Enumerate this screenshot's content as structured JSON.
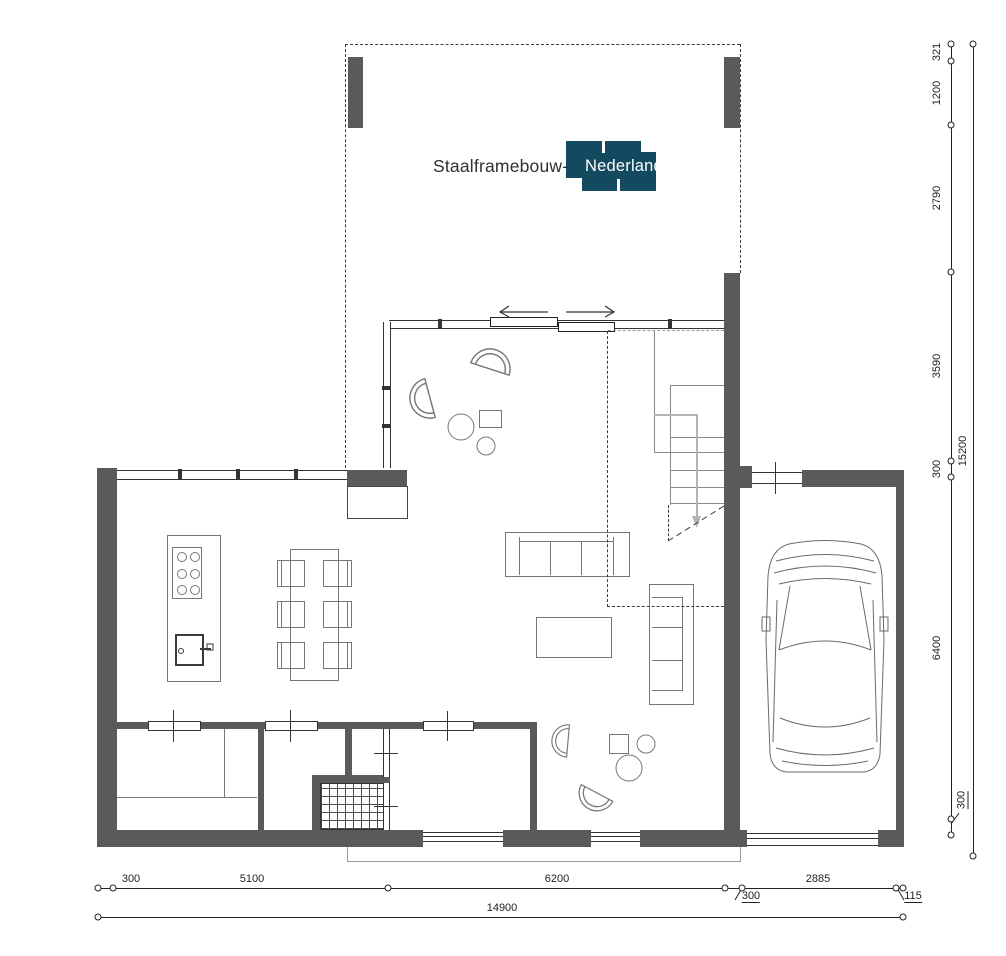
{
  "logo": {
    "text_black": "Staalframebouw-",
    "text_white": "Nederland"
  },
  "dimensions": {
    "right_chain": [
      "321",
      "1200",
      "2790",
      "3590",
      "300",
      "6400",
      "300"
    ],
    "right_total": "15200",
    "bottom_chain": [
      "300",
      "5100",
      "6200",
      "300",
      "2885",
      "115"
    ],
    "bottom_total": "14900"
  },
  "colors": {
    "wall": "#5a5a5a",
    "logo_background": "#134a5f",
    "furniture_line": "#767676",
    "dimension_text": "#222222"
  }
}
